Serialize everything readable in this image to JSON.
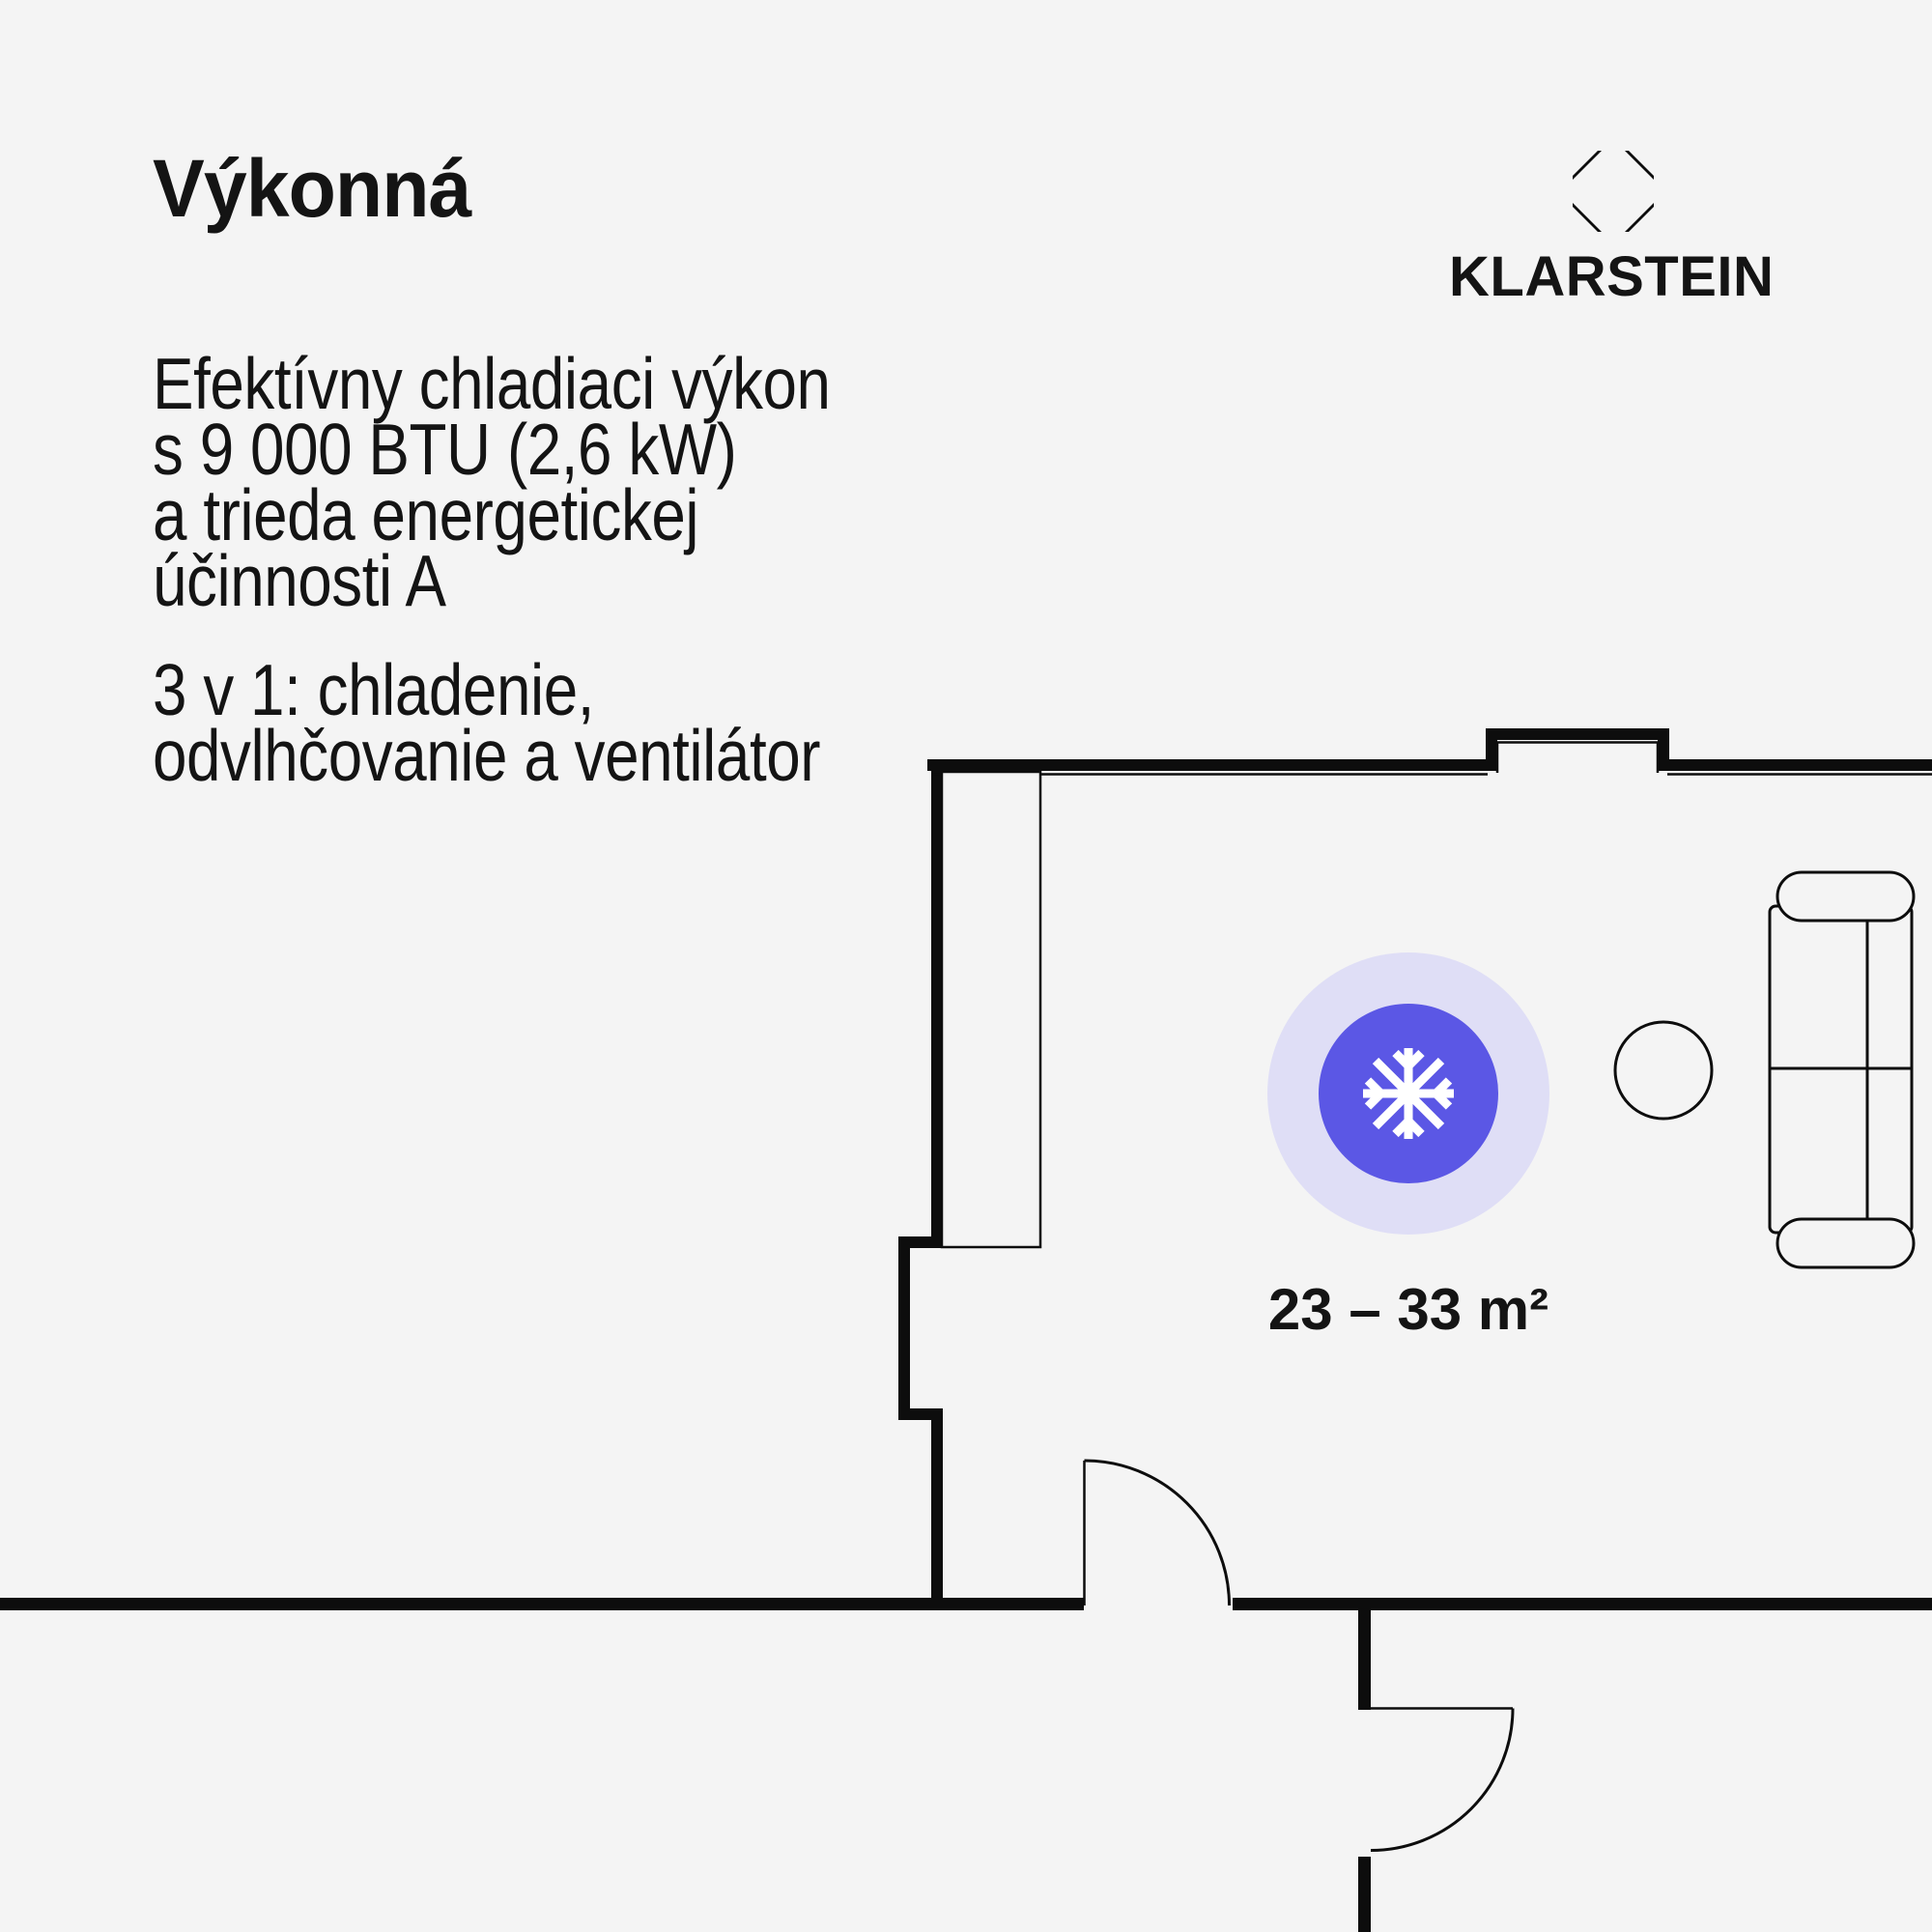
{
  "theme": {
    "bg": "#f4f4f4",
    "text": "#141414",
    "wall": "#0d0d0d",
    "accent": "#5b57e5",
    "halo": "#dfdef6",
    "icon": "#ffffff"
  },
  "header": {
    "title": "Výkonná"
  },
  "brand": {
    "name": "KLARSTEIN",
    "logo_icon": "octagon-diamond-icon"
  },
  "paragraphs": [
    {
      "lines": [
        "Efektívny chladiaci výkon",
        "s 9 000 BTU (2,6 kW)",
        "a trieda energetickej",
        "účinnosti A"
      ]
    },
    {
      "lines": [
        "3 v 1: chladenie,",
        "odvlhčovanie a ventilátor"
      ]
    }
  ],
  "floorplan": {
    "type": "apartment floor plan with cooling coverage badge",
    "area_label": "23 – 33 m²",
    "badge": {
      "icon": "snowflake-icon",
      "inner_color": "#5b57e5",
      "halo_color": "#dfdef6"
    },
    "furniture": [
      "closet",
      "sofa",
      "side-table"
    ],
    "doors": 2
  }
}
